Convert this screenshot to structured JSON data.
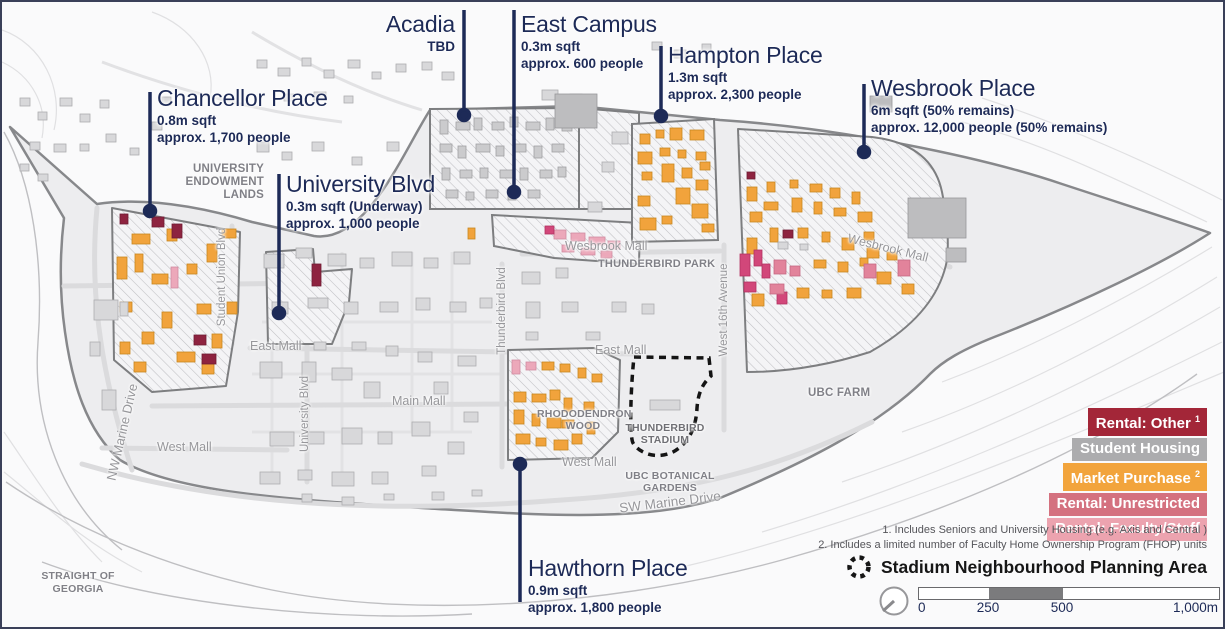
{
  "colors": {
    "callout_navy": "#1D2A57",
    "rental_other": "#A32638",
    "student_housing": "#ACACAE",
    "market_purchase": "#F2A43C",
    "rental_unrestricted": "#D4717F",
    "rental_faculty_staff": "#ECA3AF"
  },
  "callouts": {
    "chancellor": {
      "title": "Chancellor Place",
      "stat1": "0.8m sqft",
      "stat2": "approx. 1,700 people"
    },
    "university_blvd": {
      "title": "University Blvd",
      "stat1": "0.3m sqft (Underway)",
      "stat2": "approx. 1,000 people"
    },
    "acadia": {
      "title": "Acadia",
      "stat1": "TBD",
      "stat2": ""
    },
    "east_campus": {
      "title": "East Campus",
      "stat1": "0.3m sqft",
      "stat2": "approx. 600 people"
    },
    "hampton": {
      "title": "Hampton Place",
      "stat1": "1.3m sqft",
      "stat2": "approx. 2,300 people"
    },
    "wesbrook": {
      "title": "Wesbrook Place",
      "stat1": "6m sqft (50% remains)",
      "stat2": "approx. 12,000 people (50% remains)"
    },
    "hawthorn": {
      "title": "Hawthorn Place",
      "stat1": "0.9m sqft",
      "stat2": "approx. 1,800 people"
    }
  },
  "map_labels": {
    "university_endowment_lands": "UNIVERSITY ENDOWMENT LANDS",
    "student_union_blvd": "Student Union Blvd",
    "east_mall_upper": "East Mall",
    "east_mall_lower": "East Mall",
    "west_mall_left": "West Mall",
    "west_mall_right": "West Mall",
    "nw_marine_drive": "NW Marine Drive",
    "sw_marine_drive": "SW Marine Drive",
    "university_blvd_road": "University Blvd",
    "main_mall": "Main Mall",
    "thunderbird_blvd": "Thunderbird Blvd",
    "wesbrook_mall_west": "Wesbrook Mall",
    "wesbrook_mall_east": "Wesbrook Mall",
    "thunderbird_park": "THUNDERBIRD PARK",
    "west_16th_avenue": "West 16th Avenue",
    "ubc_farm": "UBC FARM",
    "rhododendron_wood": "RHODODENDRON WOOD",
    "thunderbird_stadium": "THUNDERBIRD STADIUM",
    "ubc_botanical_gardens": "UBC BOTANICAL GARDENS",
    "straight_of_georgia": "STRAIGHT OF GEORGIA"
  },
  "legend": {
    "items": [
      {
        "label": "Rental: Other",
        "sup": "1",
        "color": "#A32638"
      },
      {
        "label": "Student Housing",
        "sup": "",
        "color": "#ACACAE"
      },
      {
        "label": "Market Purchase",
        "sup": "2",
        "color": "#F2A43C"
      },
      {
        "label": "Rental: Unrestricted",
        "sup": "",
        "color": "#D4717F"
      },
      {
        "label": "Rental: Faculty/Staff",
        "sup": "",
        "color": "#ECA3AF"
      }
    ],
    "footnotes": [
      "1. Includes Seniors and University Housing (e.g. Axis and Central )",
      "2.  Includes a limited number of Faculty Home Ownership Program (FHOP) units"
    ],
    "stadium_label": "Stadium Neighbourhood Planning Area"
  },
  "scale_bar": {
    "tick_0": "0",
    "tick_250": "250",
    "tick_500": "500",
    "tick_1000": "1,000m"
  }
}
